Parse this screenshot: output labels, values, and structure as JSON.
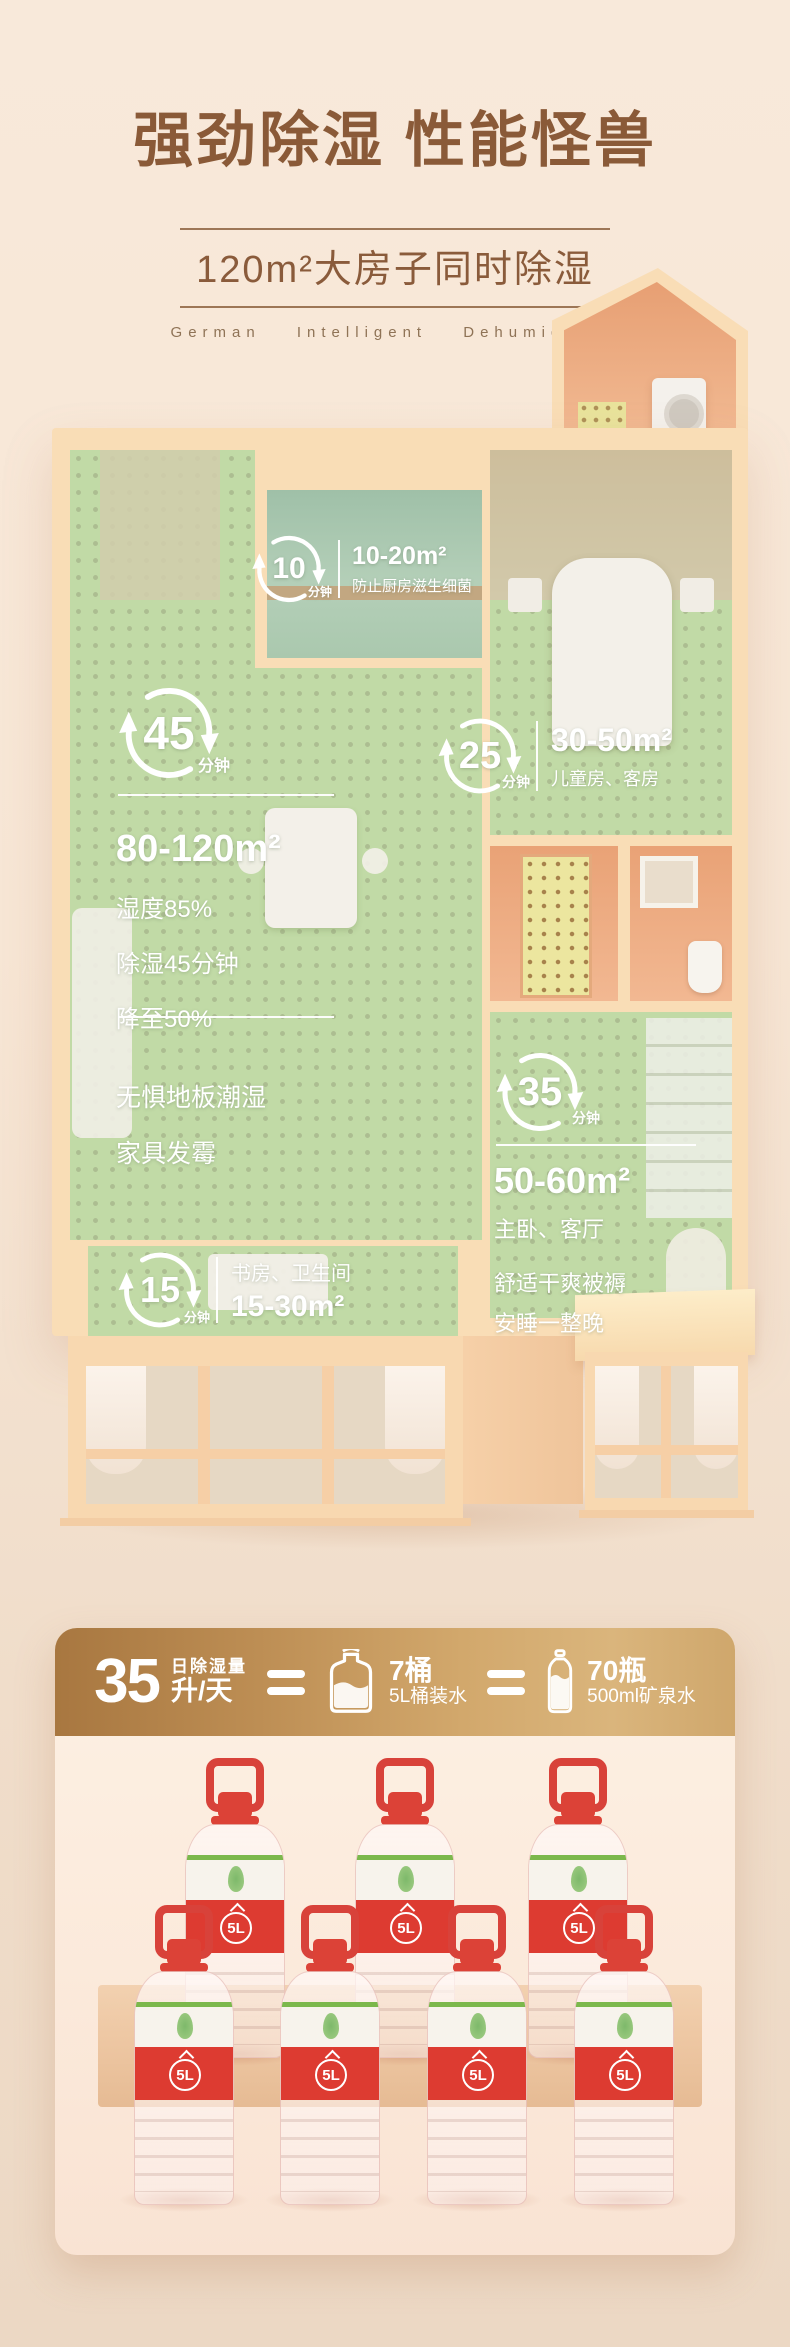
{
  "colors": {
    "title_brown": "#8a5a38",
    "wall_peach": "#f9ddb6",
    "floor_green": "#cfe28e",
    "gold_left": "#a87740",
    "gold_right": "#dab57c",
    "bottle_red": "#dd3b31"
  },
  "header": {
    "title": "强劲除湿 性能怪兽",
    "subtitle": "120m²大房子同时除湿",
    "tagline": "German Intelligent Dehumidifier"
  },
  "floorplan": {
    "kitchen": {
      "minutes": "10",
      "unit": "分钟",
      "area": "10-20m²",
      "desc": "防止厨房滋生细菌"
    },
    "living": {
      "minutes": "45",
      "unit": "分钟",
      "area": "80-120m²",
      "line1": "湿度85%",
      "line2": "除湿45分钟",
      "line3": "降至50%",
      "line4": "无惧地板潮湿",
      "line5": "家具发霉"
    },
    "kids": {
      "minutes": "25",
      "unit": "分钟",
      "area": "30-50m²",
      "desc": "儿童房、客房"
    },
    "master": {
      "minutes": "35",
      "unit": "分钟",
      "area": "50-60m²",
      "desc": "主卧、客厅",
      "line1": "舒适干爽被褥",
      "line2": "安睡一整晚"
    },
    "study": {
      "minutes": "15",
      "unit": "分钟",
      "rooms": "书房、卫生间",
      "area": "15-30m²"
    }
  },
  "equivalence": {
    "value": "35",
    "label_top": "日除湿量",
    "label_bottom": "升/天",
    "equals": "=",
    "jug_count": "7桶",
    "jug_desc": "5L桶装水",
    "bottle_count": "70瓶",
    "bottle_desc": "500ml矿泉水",
    "bottle_label": "5L"
  }
}
